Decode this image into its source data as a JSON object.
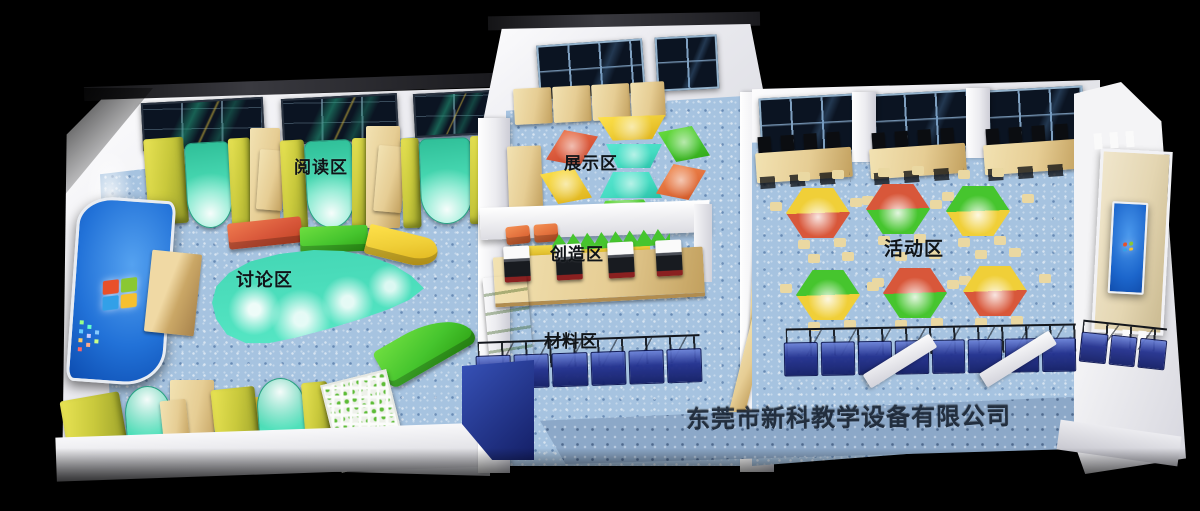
{
  "zones": {
    "reading": {
      "label": "阅读区"
    },
    "display": {
      "label": "展示区"
    },
    "discussion": {
      "label": "讨论区"
    },
    "creation": {
      "label": "创造区"
    },
    "materials": {
      "label": "材料区"
    },
    "activity": {
      "label": "活动区"
    }
  },
  "watermark": {
    "company_name": "东莞市新科教学设备有限公司"
  },
  "icons": {
    "windows_logo": "windows-logo",
    "wall_screen_logo": "windows-logo"
  },
  "palette": {
    "floor_blue": "#a6c3e0",
    "apron_blue": "#8ca8c8",
    "wall_white": "#efeff2",
    "wood_tan": "#e6cd94",
    "sofa_yellow": "#c9c93c",
    "lounge_teal": "#4fe0ba",
    "table_teal": "#46dcc2",
    "bench_red": "#d8573a",
    "bench_green": "#46c52e",
    "bench_yellow": "#f0cf38",
    "table_orange": "#e2703c",
    "screen_blue": "#1c66cc",
    "bin_blue": "#22308e",
    "window_dark": "#0b1422",
    "panel_beige": "#e4d6b2",
    "chair": "#ead8a2",
    "label_black": "#101418"
  }
}
